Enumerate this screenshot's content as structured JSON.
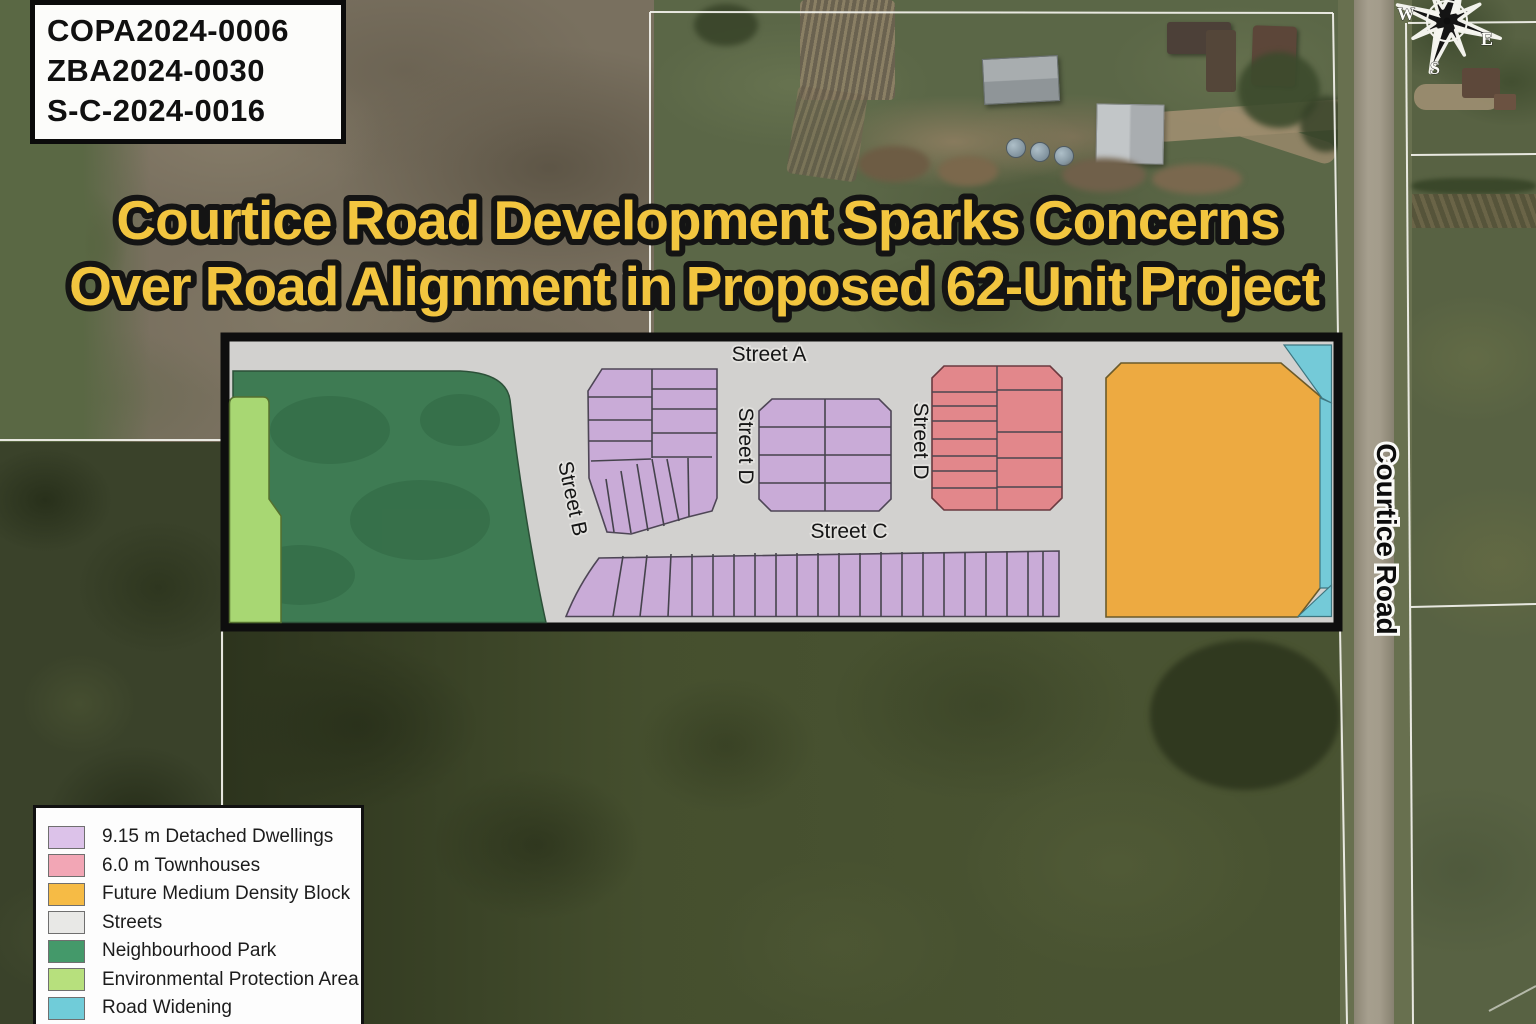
{
  "application_numbers": {
    "copa": "COPA2024-0006",
    "zba": "ZBA2024-0030",
    "sc": "S-C-2024-0016"
  },
  "headline": {
    "line1": "Courtice Road Development Sparks Concerns",
    "line2": "Over Road Alignment in Proposed 62-Unit Project",
    "text_color": "#f2c53f",
    "outline_color": "#141414"
  },
  "site_plan": {
    "street_labels": {
      "street_a": "Street A",
      "street_b": "Street B",
      "street_c": "Street C",
      "street_d_left": "Street D",
      "street_d_right": "Street D"
    },
    "road_label": "Courtice Road",
    "colors": {
      "detached_dwellings": "#c9abd7",
      "townhouses": "#e2878b",
      "future_medium_density": "#edaa41",
      "streets": "#d2d1cf",
      "neighbourhood_park": "#3e7b53",
      "environmental_protection": "#a8d773",
      "road_widening": "#74cad8",
      "plan_border": "#0e0e0e"
    }
  },
  "compass": {
    "west": "W",
    "east": "E",
    "south": "S"
  },
  "legend": {
    "items": [
      {
        "label": "9.15 m Detached Dwellings",
        "color": "#dcc2e9"
      },
      {
        "label": "6.0 m Townhouses",
        "color": "#f2a6b5"
      },
      {
        "label": "Future Medium Density Block",
        "color": "#f6bb45"
      },
      {
        "label": "Streets",
        "color": "#e8e8e6"
      },
      {
        "label": "Neighbourhood Park",
        "color": "#44996a"
      },
      {
        "label": "Environmental Protection Area",
        "color": "#b7e07d"
      },
      {
        "label": "Road Widening",
        "color": "#70ccd9"
      }
    ]
  }
}
